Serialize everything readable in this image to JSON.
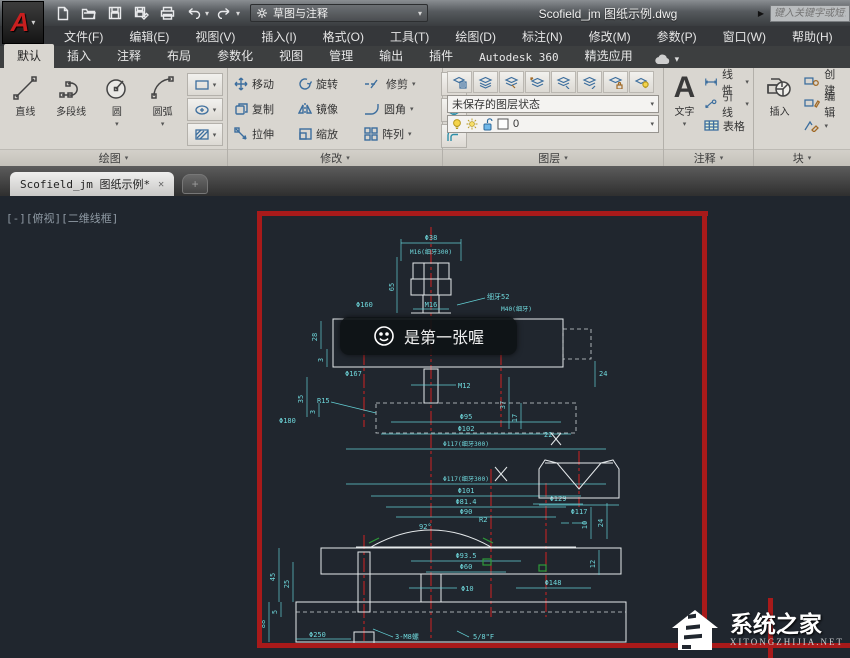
{
  "icons": {
    "caret": "▾",
    "play": "▶",
    "close": "✕",
    "plus": "+",
    "minus_box": "[-]"
  },
  "titlebar": {
    "workspace": "草图与注释",
    "title": "Scofield_jm 图纸示例.dwg",
    "search_placeholder": "键入关键字或短语",
    "logo_letter": "A"
  },
  "menu": {
    "items": [
      "文件(F)",
      "编辑(E)",
      "视图(V)",
      "插入(I)",
      "格式(O)",
      "工具(T)",
      "绘图(D)",
      "标注(N)",
      "修改(M)",
      "参数(P)",
      "窗口(W)",
      "帮助(H)"
    ]
  },
  "ribbon": {
    "tabs": [
      "默认",
      "插入",
      "注释",
      "布局",
      "参数化",
      "视图",
      "管理",
      "输出",
      "插件",
      "Autodesk 360",
      "精选应用"
    ],
    "active_tab": "默认",
    "draw": {
      "title": "绘图",
      "line": "直线",
      "polyline": "多段线",
      "circle": "圆",
      "arc": "圆弧"
    },
    "modify": {
      "title": "修改",
      "move": "移动",
      "rotate": "旋转",
      "trim": "修剪",
      "copy": "复制",
      "mirror": "镜像",
      "fillet": "圆角",
      "stretch": "拉伸",
      "scale": "缩放",
      "array": "阵列"
    },
    "layers": {
      "title": "图层",
      "state": "未保存的图层状态",
      "current": "0"
    },
    "annotate": {
      "title": "注释",
      "text": "文字",
      "linear": "线性",
      "leader": "引线",
      "table": "表格"
    },
    "block": {
      "title": "块",
      "insert": "插入",
      "create": "创建",
      "edit": "编辑"
    }
  },
  "filetab": {
    "name": "Scofield_jm 图纸示例*"
  },
  "viewport": {
    "controls": "[-][俯视][二维线框]",
    "tooltip": "是第一张喔"
  },
  "watermark": {
    "title": "系统之家",
    "sub": "XITONGZHIJIA.NET"
  },
  "drawing": {
    "dims": {
      "d38": "Φ38",
      "m16fine": "M16(细牙300)",
      "note52": "细牙52",
      "v65": "65",
      "m16": "M16",
      "m40": "M40(细牙)",
      "d160": "Φ160",
      "v28": "28",
      "v3a": "3",
      "d167": "Φ167",
      "v24": "24",
      "m12": "M12",
      "v35": "35",
      "v3b": "3",
      "v37": "37",
      "v17": "17",
      "r15": "R15",
      "d95": "Φ95",
      "d102": "Φ102",
      "d117a": "Φ117(细牙300)",
      "d180": "Φ180",
      "v22": "22",
      "d117b": "Φ117(细牙300)",
      "d101": "Φ101",
      "d814": "Φ81.4",
      "d90": "Φ90",
      "a92": "92°",
      "r2": "R2",
      "d129": "Φ129",
      "v10": "10",
      "v24b": "24",
      "v45": "45",
      "v25": "25",
      "v88": "88",
      "v5": "5",
      "d250": "Φ250",
      "m8": "3-M8螺",
      "f58": "5/8\"F",
      "d935": "Φ93.5",
      "d60": "Φ60",
      "d10": "Φ10",
      "d148": "Φ148",
      "v12": "12",
      "detail_d117": "Φ117"
    }
  }
}
